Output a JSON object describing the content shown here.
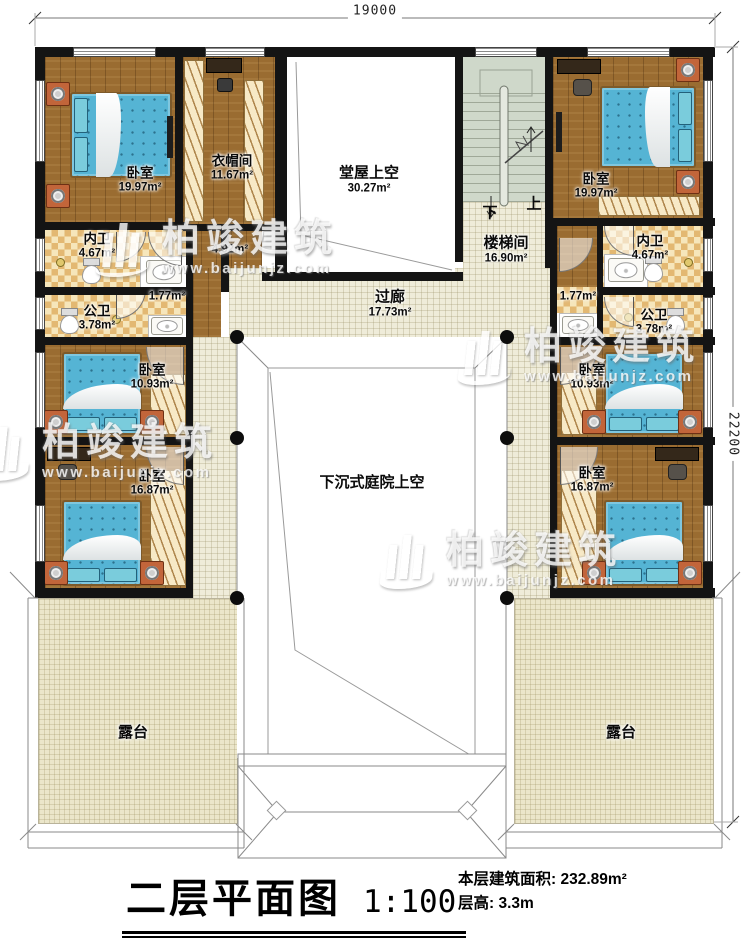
{
  "title_block": {
    "name": "二层平面图",
    "scale": "1:100",
    "area_label": "本层建筑面积: 232.89m²",
    "height_label": "层高: 3.3m"
  },
  "dimensions": {
    "top": "19000",
    "right": "22200"
  },
  "watermark": {
    "name": "柏竣建筑",
    "url": "www.baijunjz.com"
  },
  "stair": {
    "down": "下",
    "up": "上"
  },
  "rooms": [
    {
      "name": "卧室",
      "area": "19.97m²"
    },
    {
      "name": "衣帽间",
      "area": "11.67m²"
    },
    {
      "name": "堂屋上空",
      "area": "30.27m²"
    },
    {
      "name": "楼梯间",
      "area": "16.90m²"
    },
    {
      "name": "卧室",
      "area": "19.97m²"
    },
    {
      "name": "内卫",
      "area": "4.67m²"
    },
    {
      "area": "4.92m²"
    },
    {
      "name": "内卫",
      "area": "4.67m²"
    },
    {
      "name": "公卫",
      "area": "3.78m²"
    },
    {
      "area": "1.77m²"
    },
    {
      "area": "1.77m²"
    },
    {
      "name": "公卫",
      "area": "3.78m²"
    },
    {
      "name": "过廊",
      "area": "17.73m²"
    },
    {
      "name": "卧室",
      "area": "10.93m²"
    },
    {
      "name": "卧室",
      "area": "10.93m²"
    },
    {
      "name": "卧室",
      "area": "16.87m²"
    },
    {
      "name": "卧室",
      "area": "16.87m²"
    },
    {
      "name": "下沉式庭院上空"
    },
    {
      "name": "露台"
    },
    {
      "name": "露台"
    }
  ],
  "colors": {
    "wall": "#141414",
    "wood_floor": "#9a6c31",
    "tile_floor": "#e9c98c",
    "corridor_floor": "#efecd9",
    "stair_floor": "#cfd8ca",
    "terrace_floor": "#ebe6ca",
    "bed": "#55b4d4"
  }
}
